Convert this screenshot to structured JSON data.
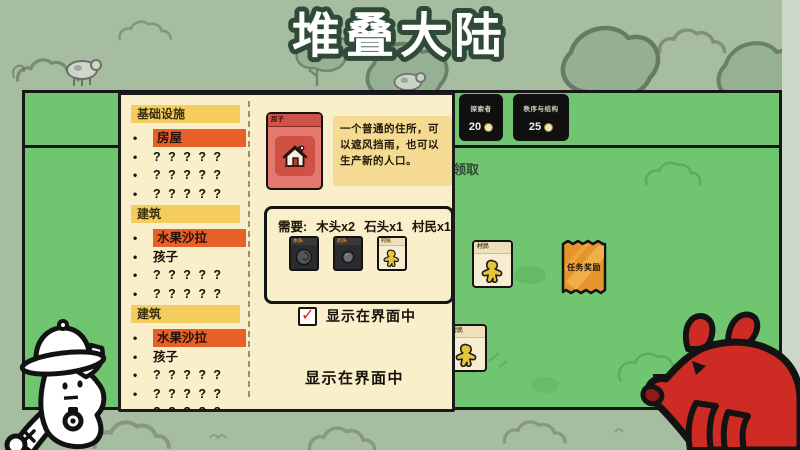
{
  "title": "堆叠大陆",
  "top_bar": {
    "packs": [
      {
        "name": "探索者",
        "price": "20"
      },
      {
        "name": "秩序与结构",
        "price": "25"
      }
    ]
  },
  "board": {
    "claim_text": "领取",
    "villager_card_1": {
      "title": "村民"
    },
    "villager_card_2": {
      "title": "村民"
    },
    "quest_pack": {
      "label": "任务奖励"
    }
  },
  "panel": {
    "sections": [
      {
        "header": "基础设施",
        "items": [
          {
            "label": "房屋",
            "highlight": true
          },
          {
            "label": "? ? ? ? ?",
            "highlight": false
          },
          {
            "label": "? ? ? ? ?",
            "highlight": false
          },
          {
            "label": "? ? ? ? ?",
            "highlight": false
          }
        ]
      },
      {
        "header": "建筑",
        "items": [
          {
            "label": "水果沙拉",
            "highlight": true
          },
          {
            "label": "孩子",
            "highlight": false
          },
          {
            "label": "? ? ? ? ?",
            "highlight": false
          },
          {
            "label": "? ? ? ? ?",
            "highlight": false
          }
        ]
      },
      {
        "header": "建筑",
        "items": [
          {
            "label": "水果沙拉",
            "highlight": true
          },
          {
            "label": "孩子",
            "highlight": false
          },
          {
            "label": "? ? ? ? ?",
            "highlight": false
          },
          {
            "label": "? ? ? ? ?",
            "highlight": false
          },
          {
            "label": "? ? ? ? ?",
            "highlight": false
          },
          {
            "label": "? ? ? ? ?",
            "highlight": false
          }
        ]
      }
    ],
    "detail": {
      "card_title": "房子",
      "description": "一个普通的住所，可以遮风挡雨，也可以生产新的人口。",
      "requirements": {
        "prefix": "需要:",
        "items": [
          {
            "qty_label": "木头x2",
            "card_name": "木头"
          },
          {
            "qty_label": "石头x1",
            "card_name": "石头"
          },
          {
            "qty_label": "村民x1",
            "card_name": "村民"
          }
        ]
      },
      "checkbox": {
        "label": "显示在界面中",
        "checked": true
      },
      "secondary_label": "显示在界面中"
    }
  },
  "icons": {
    "check": "✓",
    "bullet": "•"
  },
  "colors": {
    "board_green": "#70c570",
    "panel_cream": "#f9efcb",
    "header_yellow": "#f5cd5e",
    "highlight_orange": "#e7602a",
    "card_red": "#e5786e",
    "pack_orange": "#e6952d",
    "badge_black": "#101010",
    "rat_red": "#ce2b24"
  }
}
